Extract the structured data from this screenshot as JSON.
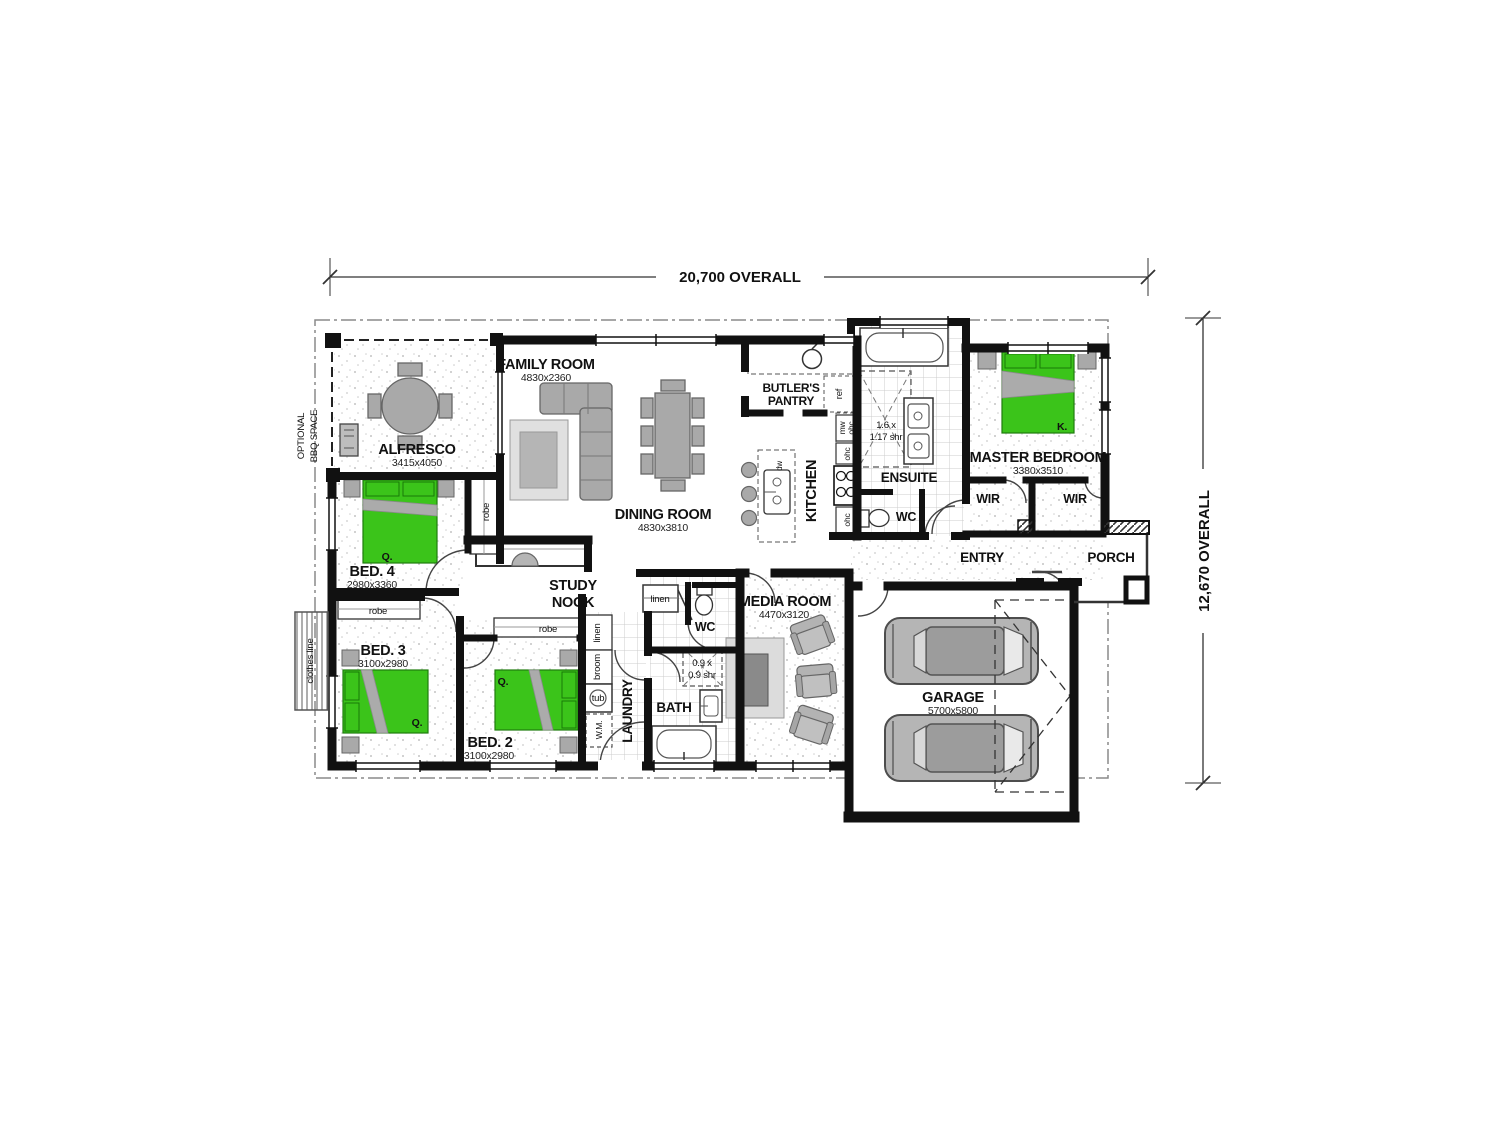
{
  "dims": {
    "top": "20,700 OVERALL",
    "right": "12,670 OVERALL"
  },
  "site": {
    "optional1": "OPTIONAL",
    "optional2": "BBQ SPACE",
    "clothes": "clothes line"
  },
  "rooms": {
    "alfresco": {
      "name": "ALFRESCO",
      "size": "3415x4050"
    },
    "family": {
      "name": "FAMILY ROOM",
      "size": "4830x2360"
    },
    "dining": {
      "name": "DINING ROOM",
      "size": "4830x3810"
    },
    "pantry": {
      "line1": "BUTLER'S",
      "line2": "PANTRY"
    },
    "kitchen": {
      "name": "KITCHEN"
    },
    "ensuite": {
      "name": "ENSUITE"
    },
    "wc_ensuite": {
      "name": "WC"
    },
    "master": {
      "name": "MASTER BEDROOM",
      "size": "3380x3510"
    },
    "wir_left": {
      "name": "WIR"
    },
    "wir_right": {
      "name": "WIR"
    },
    "entry": {
      "name": "ENTRY"
    },
    "porch": {
      "name": "PORCH"
    },
    "bed4": {
      "name": "BED. 4",
      "size": "2980x3360"
    },
    "bed3": {
      "name": "BED. 3",
      "size": "3100x2980"
    },
    "bed2": {
      "name": "BED. 2",
      "size": "3100x2980"
    },
    "study": {
      "line1": "STUDY",
      "line2": "NOOK"
    },
    "laundry": {
      "name": "LAUNDRY"
    },
    "bath": {
      "name": "BATH"
    },
    "wc_main": {
      "name": "WC"
    },
    "media": {
      "name": "MEDIA ROOM",
      "size": "4470x3120"
    },
    "garage": {
      "name": "GARAGE",
      "size": "5700x5800"
    }
  },
  "fixtures": {
    "robe": "robe",
    "linen": "linen",
    "broom": "broom",
    "tub": "tub",
    "wm": "W.M.",
    "ref": "ref",
    "mw": "mw",
    "ohc": "ohc",
    "dw": "dw",
    "shower_main1": "0.9 x",
    "shower_main2": "0.9 shr",
    "shower_ens1": "1.6 x",
    "shower_ens2": "1.17 shr",
    "bed_q": "Q.",
    "bed_k": "K."
  },
  "colors": {
    "bed_green": "#3bc41a",
    "furniture_gray": "#a9a9a9",
    "wall": "#111111"
  }
}
